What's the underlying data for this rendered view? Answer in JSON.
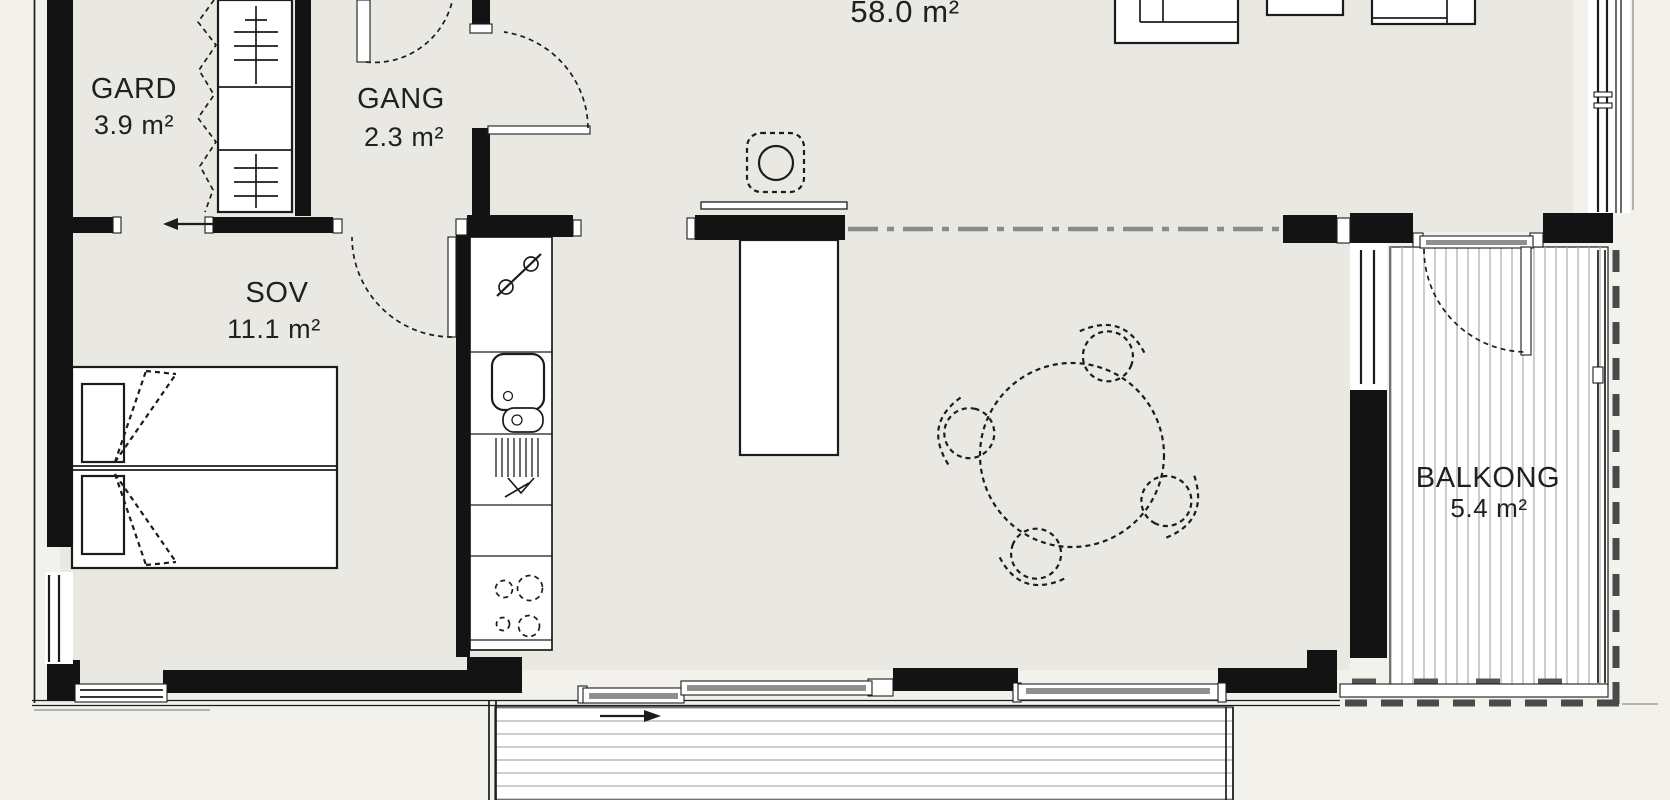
{
  "title": "apartment-floor-plan",
  "rooms": {
    "gard": {
      "label": "GARD",
      "area": "3.9 m²"
    },
    "gang": {
      "label": "GANG",
      "area": "2.3 m²"
    },
    "sov": {
      "label": "SOV",
      "area": "11.1 m²"
    },
    "living": {
      "area": "58.0 m²"
    },
    "balkong": {
      "label": "BALKONG",
      "area": "5.4 m²"
    }
  },
  "colors": {
    "wall": "#131313",
    "floor_interior": "#eae8e2",
    "background": "#f2f1ec",
    "line": "#1c1c1c",
    "glass": "#909090",
    "boundary_dash": "#4a4a4a",
    "centerline": "#8a8a8a",
    "deck_line": "#a5a5a5"
  }
}
